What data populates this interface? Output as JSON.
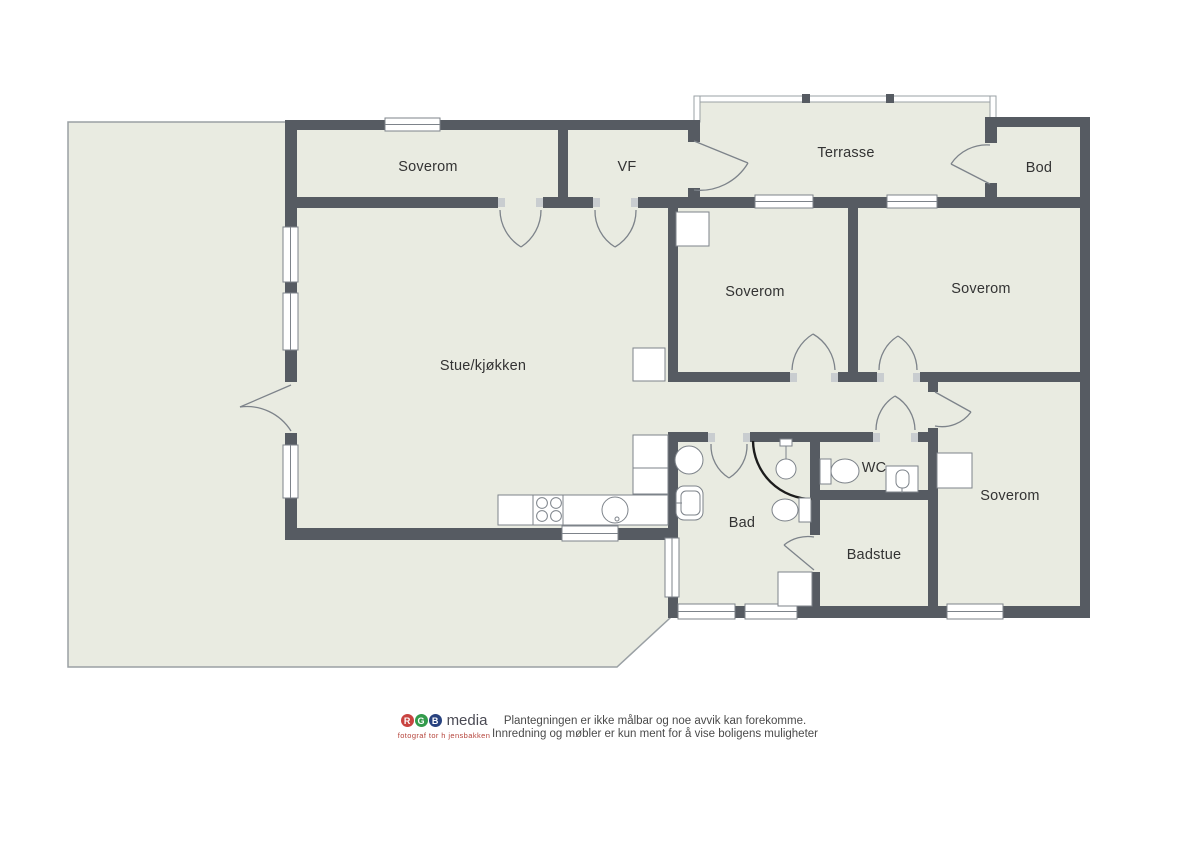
{
  "plan": {
    "rooms": {
      "soverom_top_left": {
        "label": "Soverom"
      },
      "vf": {
        "label": "VF"
      },
      "terrasse": {
        "label": "Terrasse"
      },
      "bod": {
        "label": "Bod"
      },
      "soverom_mid_left": {
        "label": "Soverom"
      },
      "soverom_mid_right": {
        "label": "Soverom"
      },
      "stue_kjokken": {
        "label": "Stue/kjøkken"
      },
      "bad": {
        "label": "Bad"
      },
      "wc": {
        "label": "WC"
      },
      "badstue": {
        "label": "Badstue"
      },
      "soverom_bottom_right": {
        "label": "Soverom"
      }
    },
    "colors": {
      "wall": "#565b62",
      "floor": "#e9ebe1",
      "outline": "#9aa0a4"
    }
  },
  "footer": {
    "logo": {
      "letter_r": "R",
      "letter_g": "G",
      "letter_b": "B",
      "name": "media",
      "tagline": "fotograf tor h jensbakken"
    },
    "disclaimer_line1": "Plantegningen er ikke målbar og noe avvik kan forekomme.",
    "disclaimer_line2": "Innredning og møbler er kun ment for å vise boligens muligheter"
  }
}
